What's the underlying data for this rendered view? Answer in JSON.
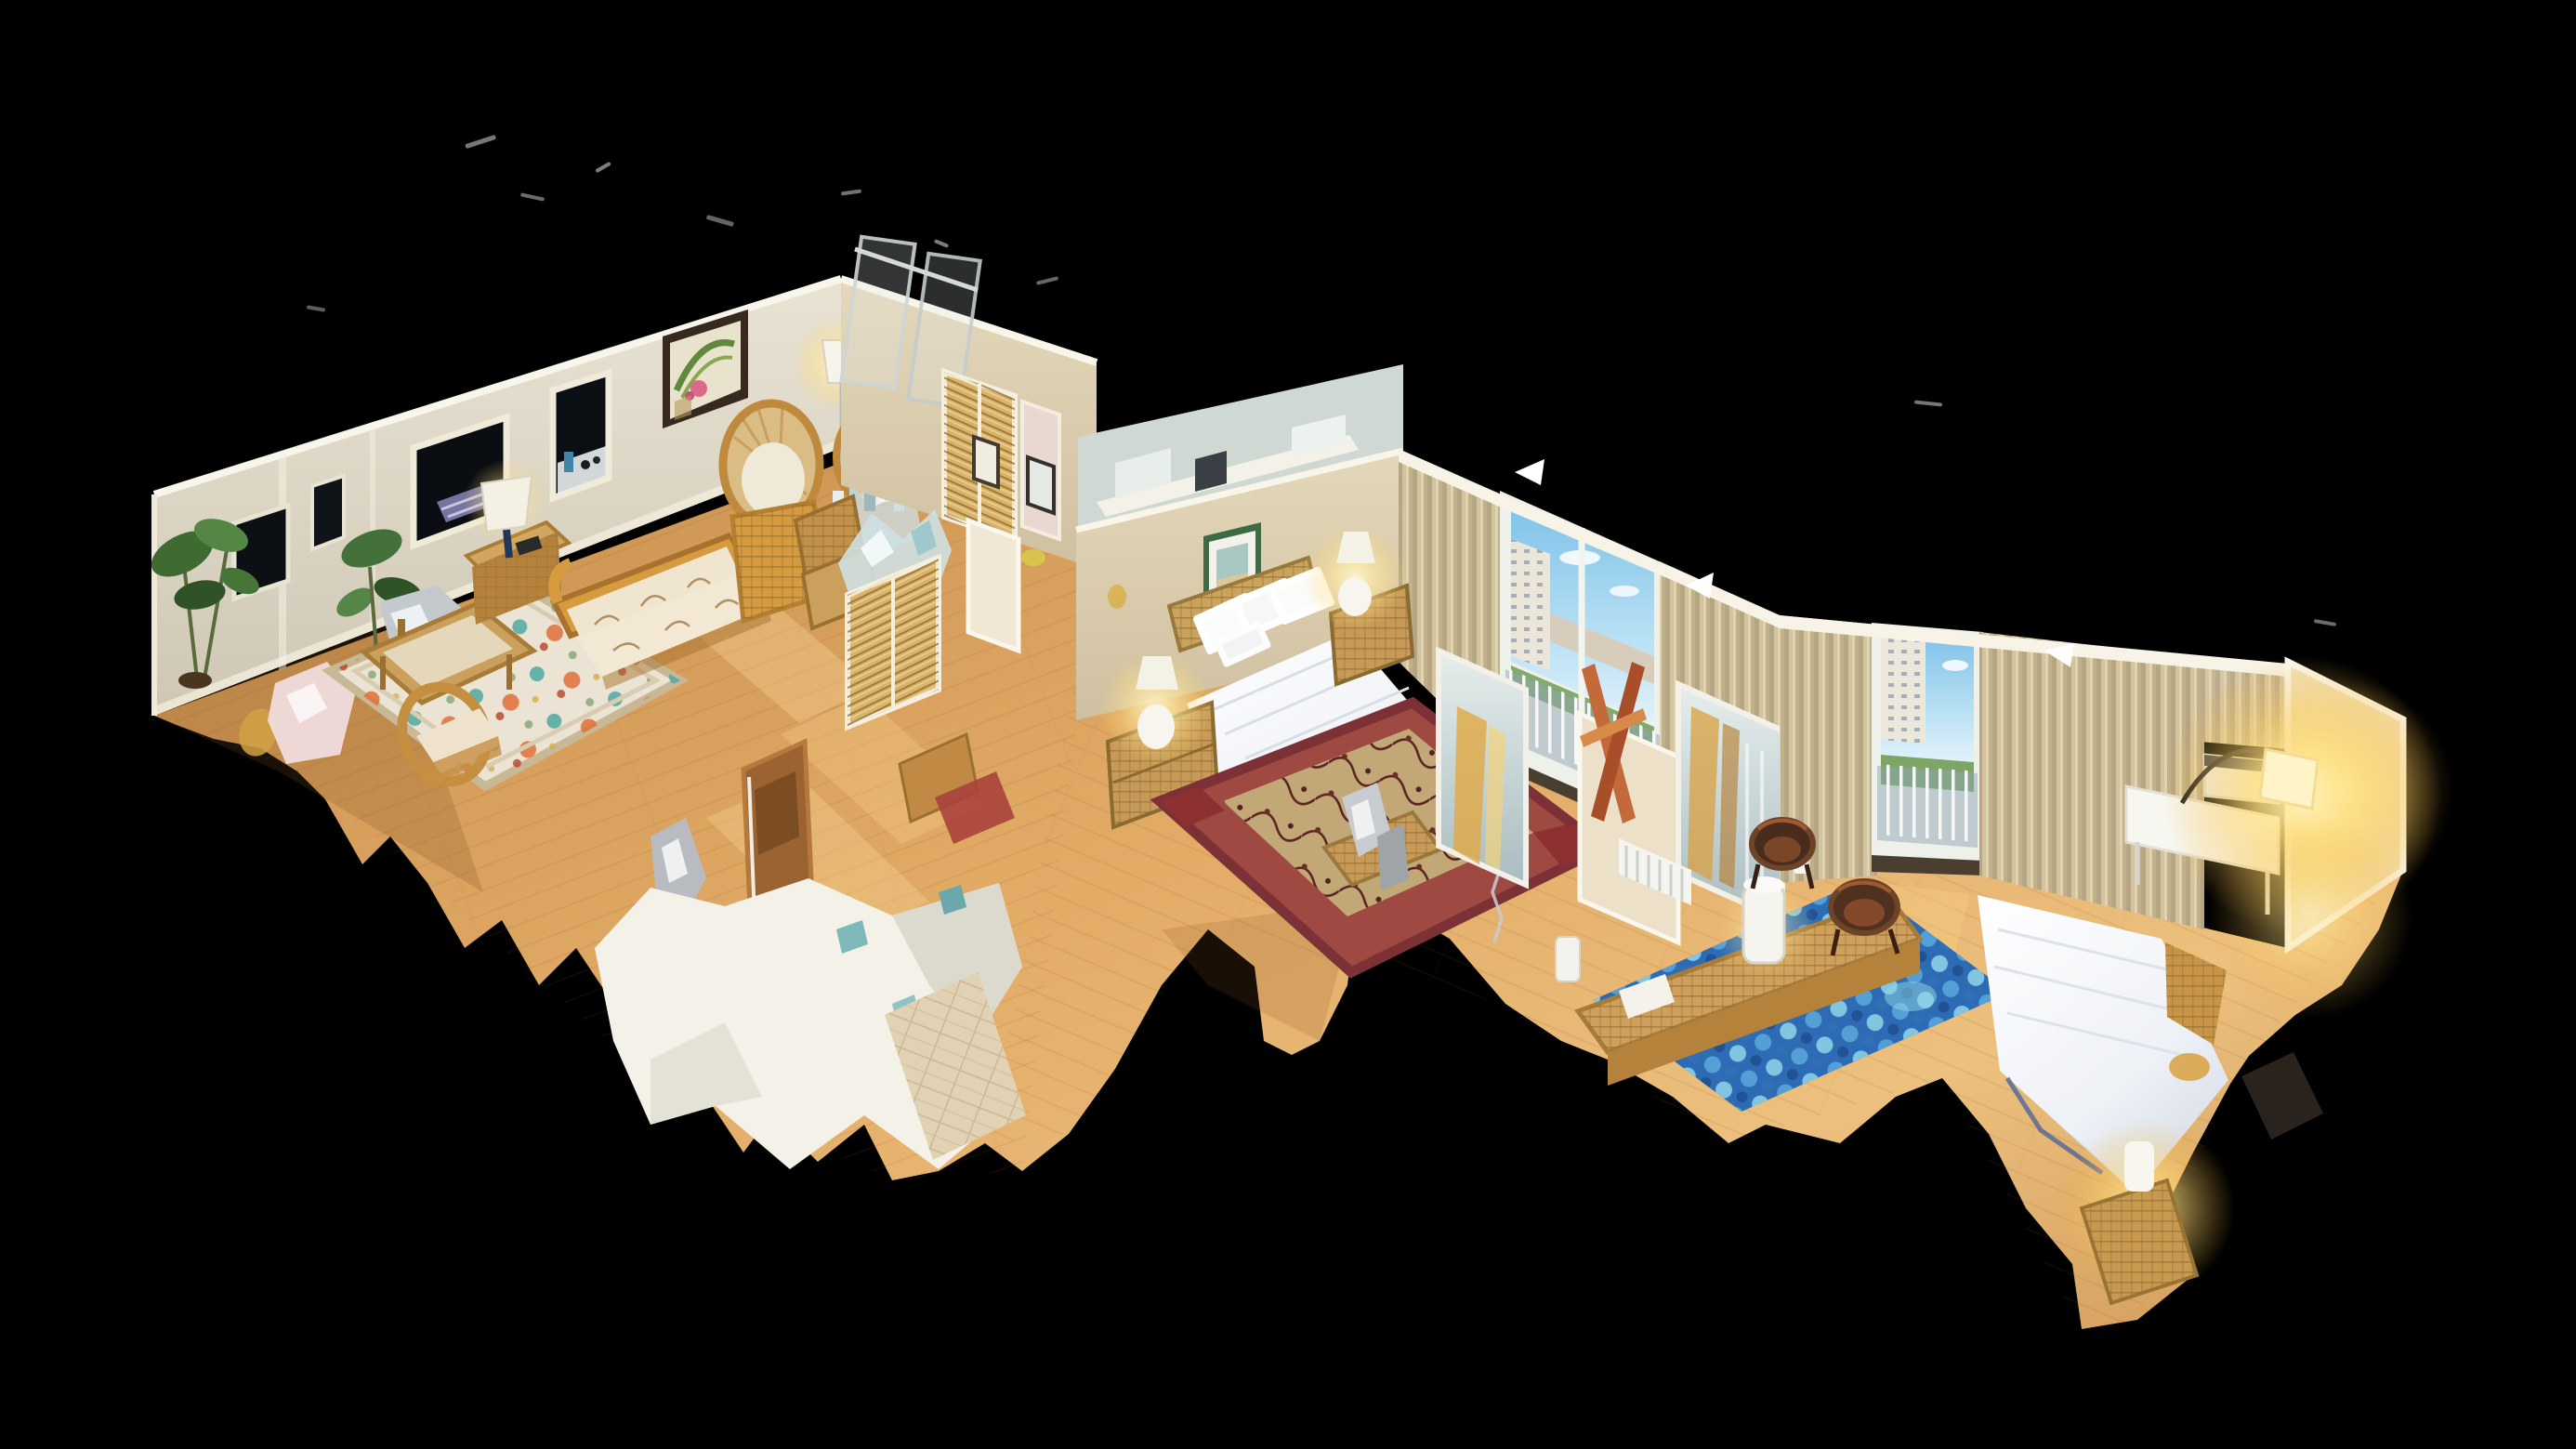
{
  "scene": {
    "description": "3D dollhouse cutaway view of a furnished apartment floating on a black background (photogrammetry scan with ragged mesh edges)",
    "background_color": "#000000",
    "palette": {
      "void": "#000000",
      "wall_cream": "#d8d2c2",
      "wall_olive": "#d8cca8",
      "wall_cut_edge": "#f8f5ea",
      "wood_floor": "#d89a55",
      "wood_floor_light": "#f2c488",
      "curtain_tan": "#c8b890",
      "sky_blue": "#7fc2e8",
      "bed_white": "#f2f4f8",
      "rug_red": "#9e4a42",
      "rug_blue": "#2d6cb4",
      "rattan": "#cfa05c",
      "lamp_glow": "#ffe9a0",
      "mirror_silver": "#cfdcda",
      "mirror_gold_streak": "#e0a944"
    },
    "rooms": [
      {
        "id": "living-room",
        "label": "living room",
        "furniture": [
          "rattan sofa with floral cushions",
          "glass coffee table",
          "side table with lamp",
          "wicker chair",
          "two fan-back wicker chairs",
          "floral rug",
          "potted plants",
          "glass bottles",
          "wicker baskets",
          "framed botanical art",
          "dark window openings"
        ]
      },
      {
        "id": "hallway",
        "label": "hallway / closets",
        "furniture": [
          "louvered closet doors",
          "bathroom mirror",
          "small framed pictures",
          "wooden door",
          "torn white wall fragment",
          "tile floor patch"
        ]
      },
      {
        "id": "master-bedroom",
        "label": "master bedroom",
        "furniture": [
          "double bed with white duvet",
          "wicker headboard",
          "two wicker nightstands",
          "two glowing white lamps",
          "green framed art",
          "burgundy vine rug",
          "tan curtains",
          "balcony door with city view",
          "mirrored closet with golden reflection",
          "wicker bench",
          "wood easel"
        ]
      },
      {
        "id": "second-bedroom",
        "label": "second bedroom",
        "furniture": [
          "white bed",
          "blue moroccan trellis rug",
          "rattan bench with white pitcher lamp",
          "two dark wood tub chairs",
          "tan curtains",
          "balcony door with railing view",
          "window AC unit",
          "white desk",
          "arc floor lamp with bright glow",
          "wicker trunk with lamp"
        ]
      }
    ],
    "view": {
      "style": "isometric dollhouse",
      "edges": "ragged black cutouts at floor borders",
      "lighting": "warm interior, bright lamp glows at right"
    }
  }
}
